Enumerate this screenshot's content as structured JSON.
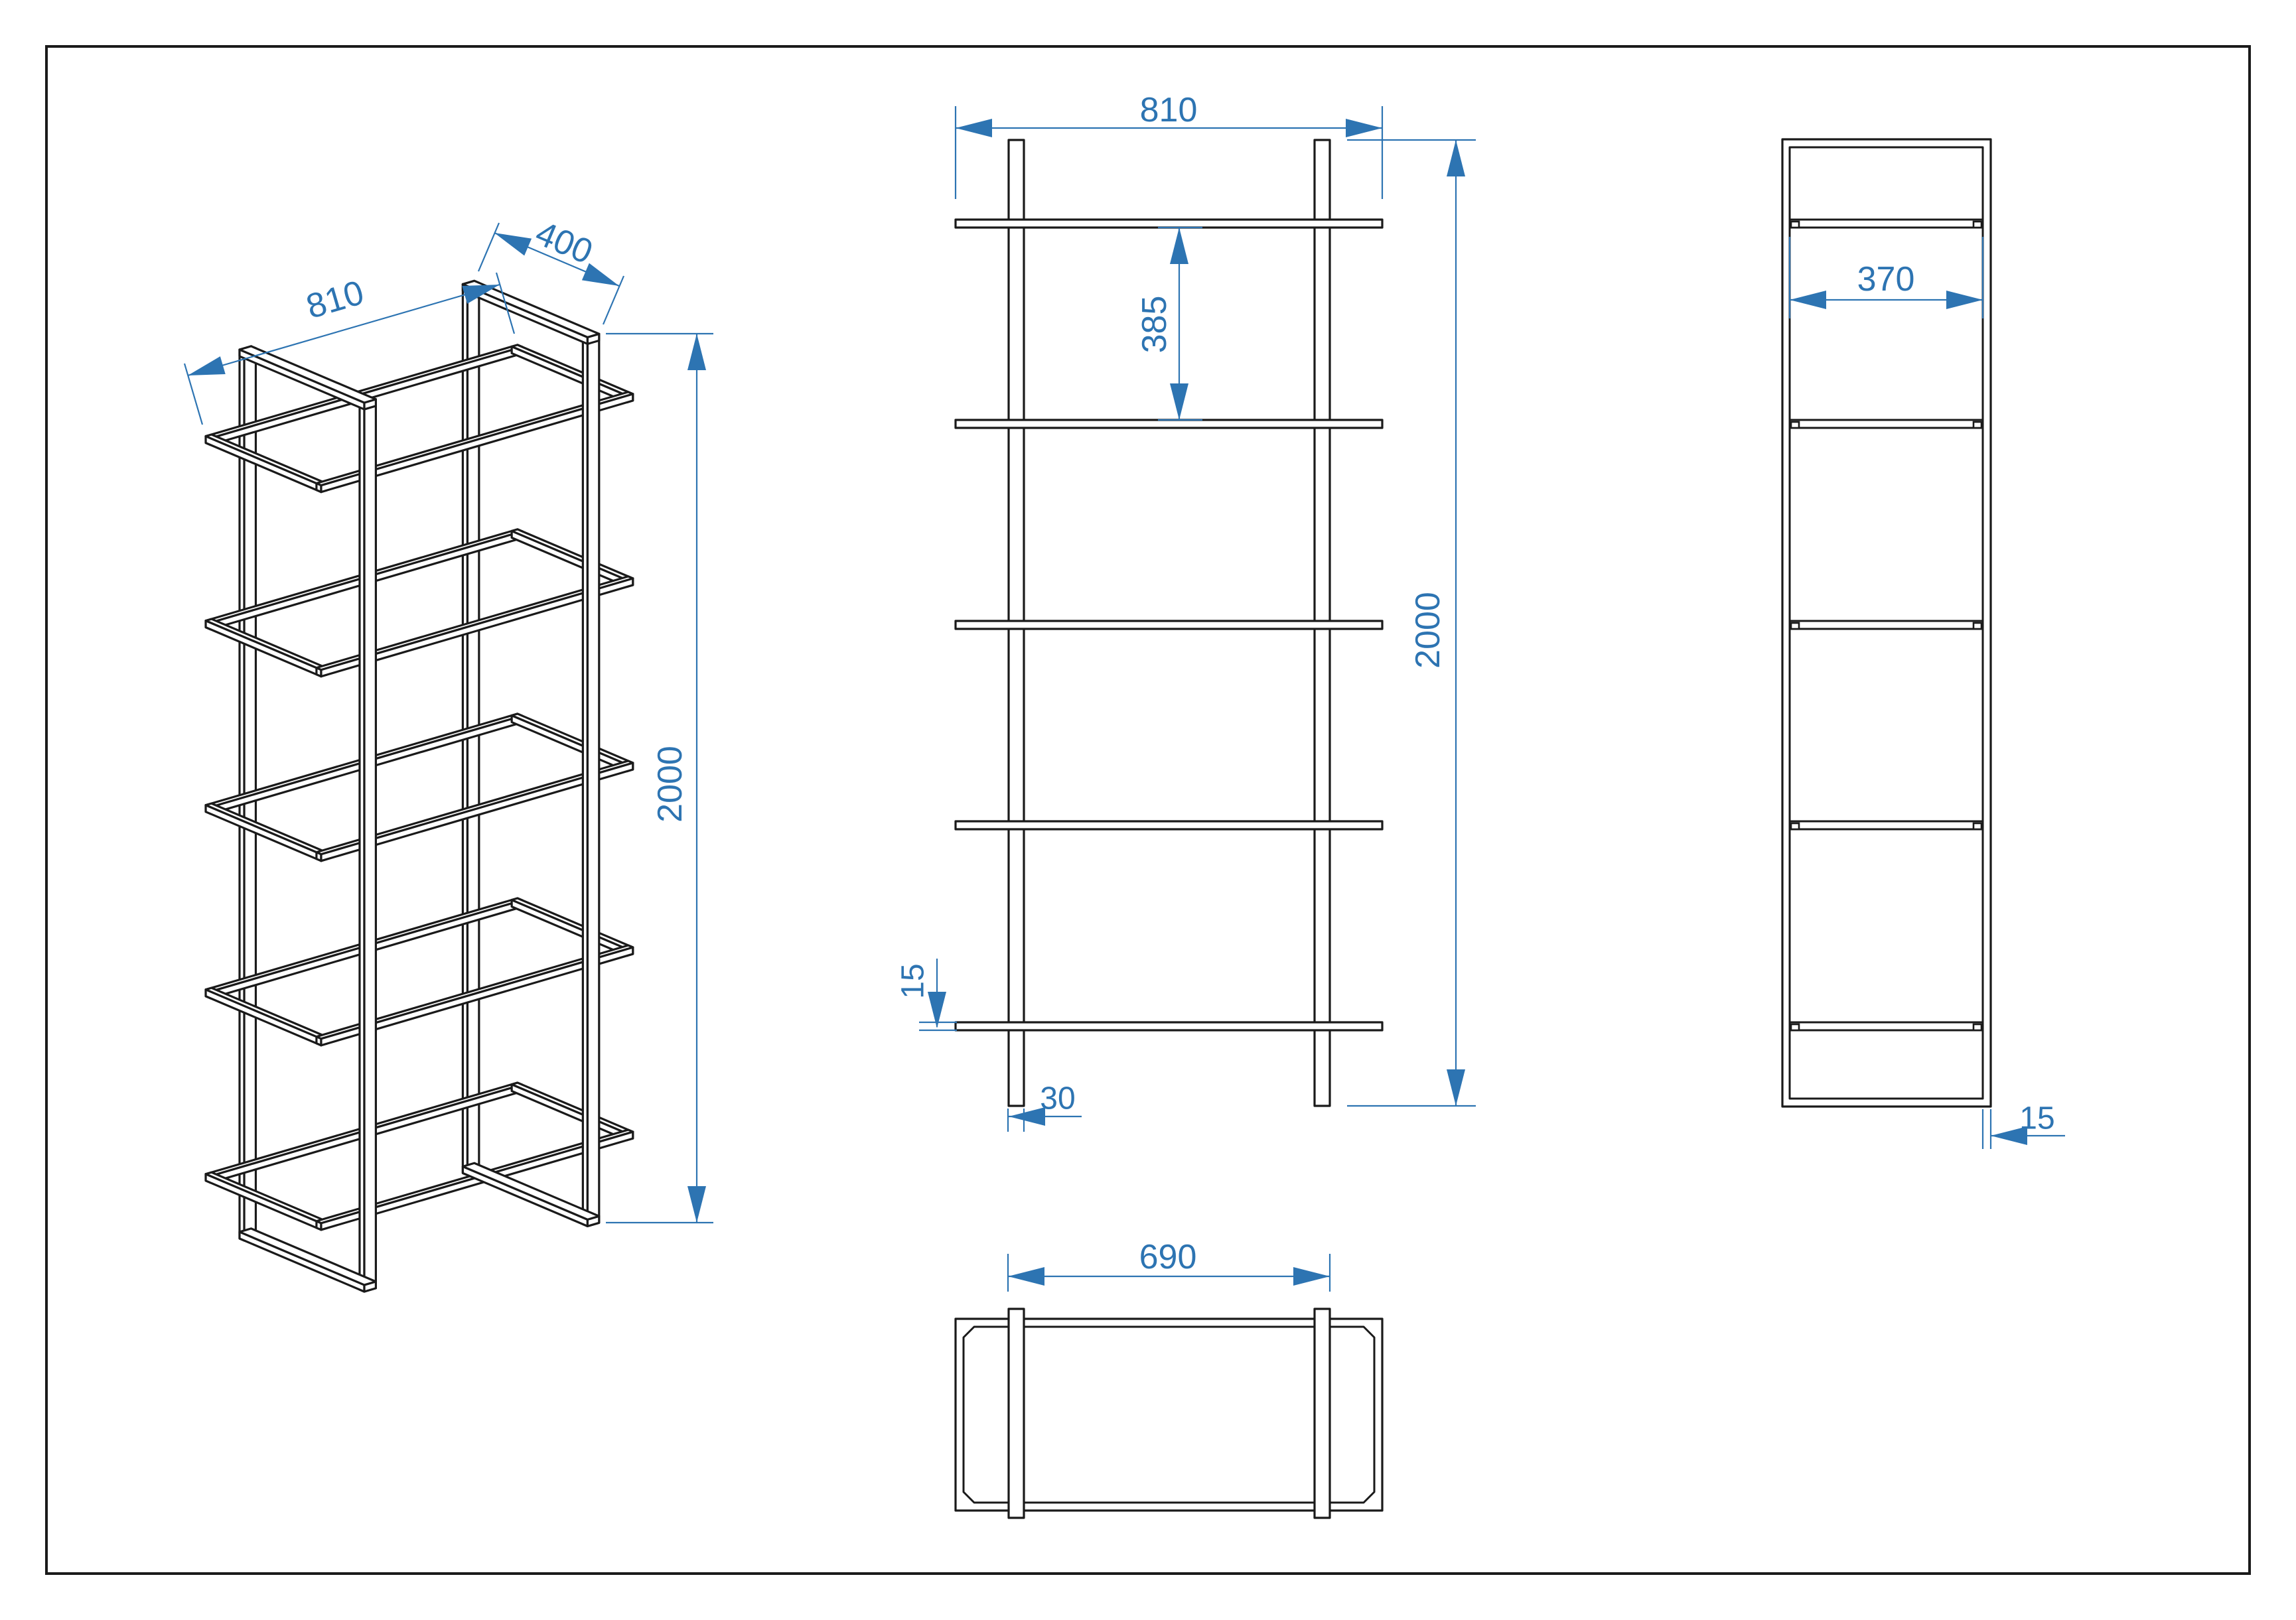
{
  "colors": {
    "accent": "#2d74b2",
    "line": "#1a1a1a",
    "paper": "#ffffff"
  },
  "views": {
    "isometric": {
      "width_label": "810",
      "depth_label": "400",
      "height_label": "2000"
    },
    "front": {
      "width_label": "810",
      "shelf_gap_label": "385",
      "height_label": "2000",
      "shelf_thickness_label": "15",
      "post_width_label": "30"
    },
    "top": {
      "post_spacing_label": "690"
    },
    "side": {
      "inner_depth_label": "370",
      "tube_thickness_label": "15"
    }
  }
}
